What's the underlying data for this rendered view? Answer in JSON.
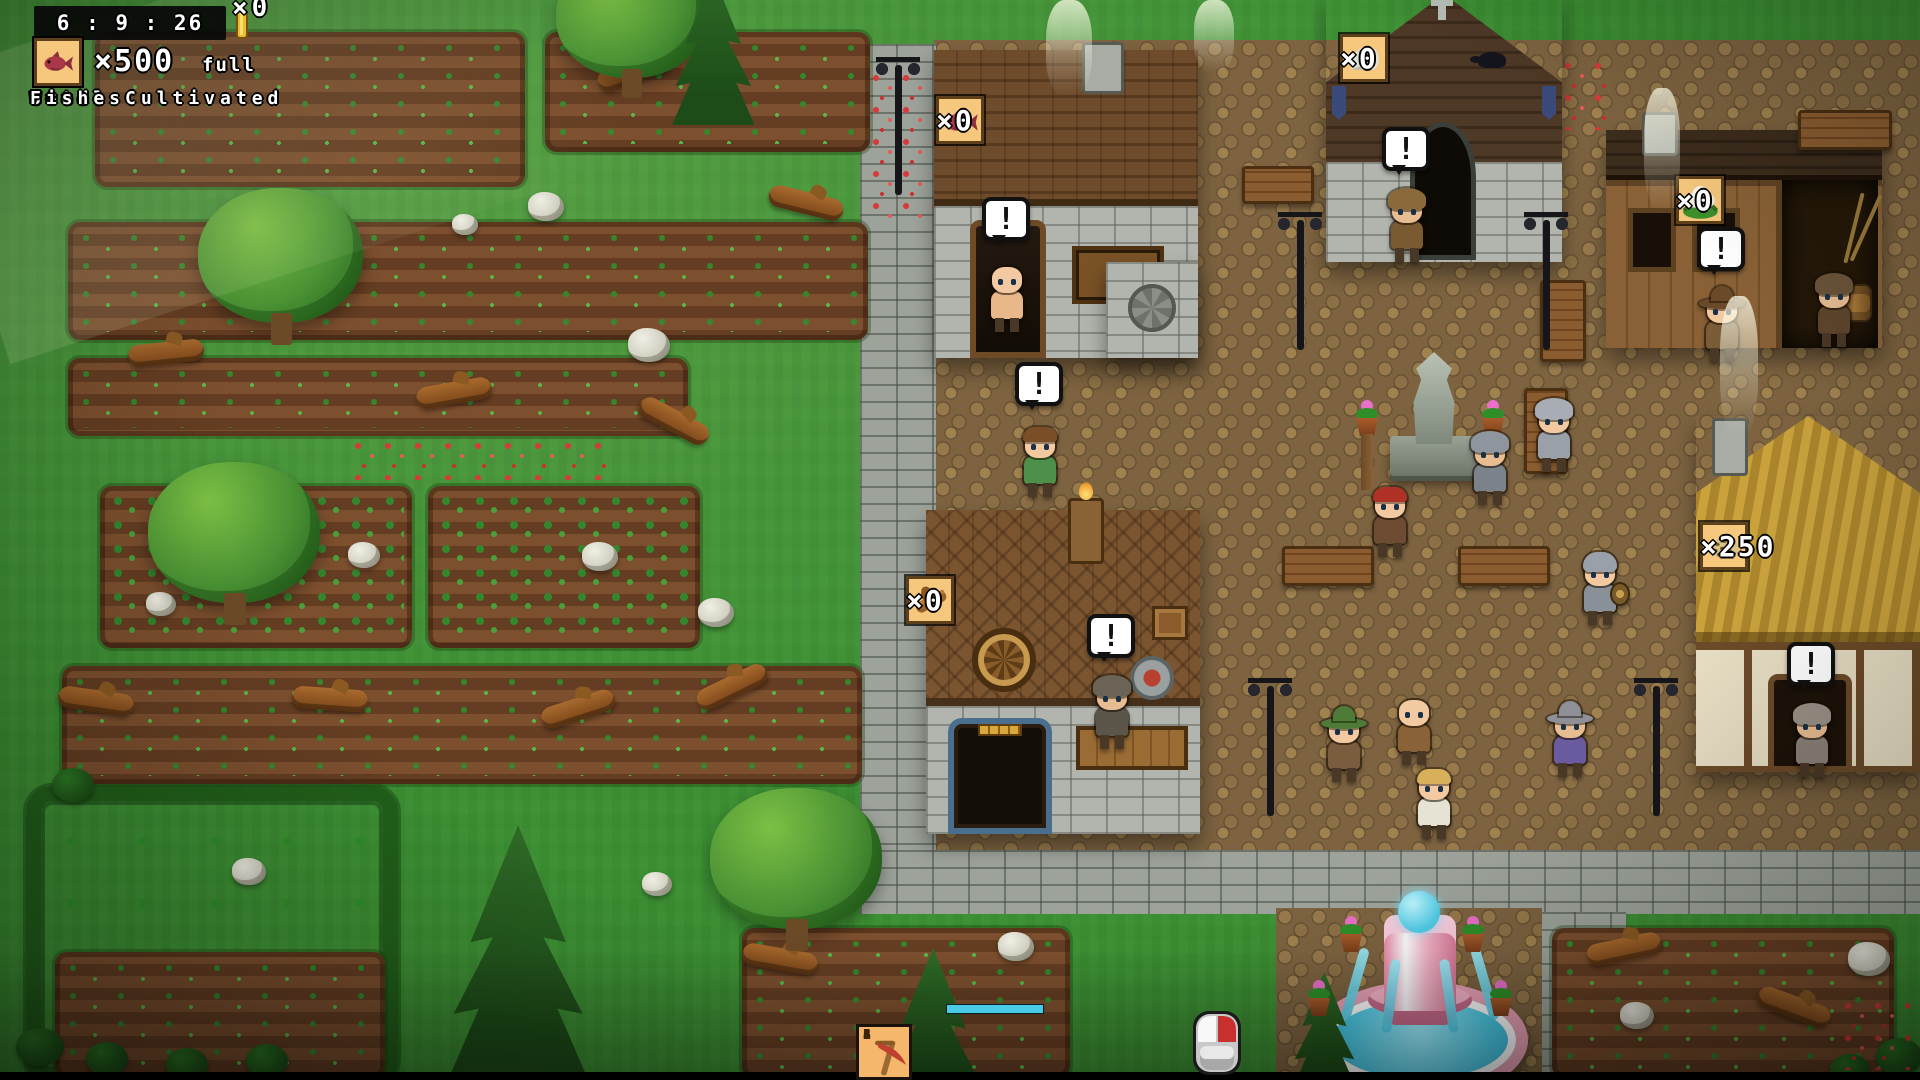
{
  "hud": {
    "clock": "6 : 9 : 26",
    "gold": {
      "icon": "gold-ingot-icon",
      "count": "×0"
    },
    "resources": [
      {
        "icon": "cauliflower-icon",
        "count": "×500",
        "suffix": "full",
        "label": "Total Cultivated"
      },
      {
        "icon": "wood-icon",
        "count": "×500",
        "suffix": "full",
        "label": "Wood"
      },
      {
        "icon": "grass-icon",
        "count": "×500",
        "suffix": "full",
        "label": "Grass"
      },
      {
        "icon": "stone-icon",
        "count": "×500",
        "suffix": "full",
        "label": "Stone"
      },
      {
        "icon": "fish-icon",
        "count": "×500",
        "suffix": "full",
        "label": "Fishes"
      }
    ]
  },
  "village_labels": [
    {
      "icon": "fish-icon",
      "count": "×0",
      "x": 936,
      "y": 96
    },
    {
      "icon": "stone-icon",
      "count": "×0",
      "x": 1340,
      "y": 34
    },
    {
      "icon": "cauliflower-icon",
      "count": "×0",
      "x": 1676,
      "y": 176
    },
    {
      "icon": "wood-icon",
      "count": "×0",
      "x": 906,
      "y": 576
    },
    {
      "icon": "seeds-icon",
      "count": "×250",
      "x": 1700,
      "y": 522
    }
  ],
  "toolbar": {
    "slots": [
      {
        "number": "1",
        "icon": "villager-icon"
      },
      {
        "number": "2",
        "icon": "pickaxe-icon"
      },
      {
        "number": "3",
        "icon": "bucket-icon"
      },
      {
        "number": "4",
        "icon": "shovel-icon"
      },
      {
        "number": "5",
        "icon": "axe-icon"
      },
      {
        "number": "6",
        "icon": "scythe-icon"
      }
    ],
    "cursor_icon": "mouse-icon",
    "progress_value": 100
  },
  "speech": {
    "exclamation": "!"
  },
  "colors": {
    "hud_box": "#f6c87e",
    "bubble": "#ffffff",
    "water": "#4ecde8",
    "progress": "#49cbe8",
    "thatch": "#c9a23c"
  },
  "scene": {
    "plots": [
      {
        "x": 95,
        "y": 32,
        "w": 430,
        "h": 155
      },
      {
        "x": 545,
        "y": 32,
        "w": 325,
        "h": 120
      },
      {
        "x": 68,
        "y": 222,
        "w": 800,
        "h": 118
      },
      {
        "x": 68,
        "y": 358,
        "w": 620,
        "h": 78
      },
      {
        "x": 100,
        "y": 486,
        "w": 312,
        "h": 162,
        "beans": true
      },
      {
        "x": 428,
        "y": 486,
        "w": 272,
        "h": 162,
        "beans": true
      },
      {
        "x": 62,
        "y": 666,
        "w": 800,
        "h": 118
      },
      {
        "x": 742,
        "y": 928,
        "w": 328,
        "h": 150
      },
      {
        "x": 1552,
        "y": 928,
        "w": 342,
        "h": 150
      },
      {
        "x": 55,
        "y": 952,
        "w": 330,
        "h": 126
      }
    ],
    "trees": [
      {
        "t": "round",
        "x": 198,
        "y": 188,
        "s": 165
      },
      {
        "t": "round",
        "x": 148,
        "y": 462,
        "s": 172
      },
      {
        "t": "round",
        "x": 710,
        "y": 788,
        "s": 172
      },
      {
        "t": "round",
        "x": 556,
        "y": -45,
        "s": 150
      },
      {
        "t": "pine",
        "x": 448,
        "y": 825,
        "s": 255
      },
      {
        "t": "pine",
        "x": 672,
        "y": -25,
        "s": 150
      },
      {
        "t": "pine",
        "x": 885,
        "y": 948,
        "s": 175
      },
      {
        "t": "pine",
        "x": 1292,
        "y": 972,
        "s": 118
      }
    ],
    "logs": [
      {
        "x": 596,
        "y": 60,
        "r": -20
      },
      {
        "x": 768,
        "y": 192,
        "r": 14
      },
      {
        "x": 416,
        "y": 382,
        "r": -10
      },
      {
        "x": 636,
        "y": 410,
        "r": 28
      },
      {
        "x": 128,
        "y": 342,
        "r": -6
      },
      {
        "x": 58,
        "y": 690,
        "r": 8
      },
      {
        "x": 292,
        "y": 688,
        "r": 4
      },
      {
        "x": 540,
        "y": 698,
        "r": -18
      },
      {
        "x": 694,
        "y": 676,
        "r": -26
      },
      {
        "x": 742,
        "y": 948,
        "r": 10
      },
      {
        "x": 1586,
        "y": 938,
        "r": -12
      },
      {
        "x": 1756,
        "y": 996,
        "r": 20
      }
    ],
    "stones": [
      {
        "x": 528,
        "y": 192,
        "s": 36
      },
      {
        "x": 452,
        "y": 214,
        "s": 26
      },
      {
        "x": 628,
        "y": 328,
        "s": 42
      },
      {
        "x": 146,
        "y": 592,
        "s": 30
      },
      {
        "x": 348,
        "y": 542,
        "s": 32
      },
      {
        "x": 582,
        "y": 542,
        "s": 36
      },
      {
        "x": 698,
        "y": 598,
        "s": 36
      },
      {
        "x": 232,
        "y": 858,
        "s": 34
      },
      {
        "x": 642,
        "y": 872,
        "s": 30
      },
      {
        "x": 998,
        "y": 932,
        "s": 36
      },
      {
        "x": 1620,
        "y": 1002,
        "s": 34
      },
      {
        "x": 1848,
        "y": 942,
        "s": 42
      }
    ],
    "bushes": [
      {
        "x": 52,
        "y": 768,
        "s": 42
      },
      {
        "x": 16,
        "y": 1028,
        "s": 48
      },
      {
        "x": 86,
        "y": 1042,
        "s": 42
      },
      {
        "x": 166,
        "y": 1048,
        "s": 42
      },
      {
        "x": 246,
        "y": 1044,
        "s": 42
      },
      {
        "x": 1876,
        "y": 1038,
        "s": 46
      },
      {
        "x": 1830,
        "y": 1054,
        "s": 40
      }
    ],
    "flowers": [
      {
        "x": 868,
        "y": 72,
        "w": 66,
        "h": 150
      },
      {
        "x": 1560,
        "y": 60,
        "w": 50,
        "h": 70
      },
      {
        "x": 1840,
        "y": 1000,
        "w": 70,
        "h": 70
      },
      {
        "x": 350,
        "y": 440,
        "w": 260,
        "h": 40
      }
    ],
    "lamps": [
      {
        "x": 868,
        "y": 55
      },
      {
        "x": 1270,
        "y": 210
      },
      {
        "x": 1516,
        "y": 210
      },
      {
        "x": 1240,
        "y": 676
      },
      {
        "x": 1626,
        "y": 676
      }
    ],
    "benches": [
      {
        "x": 1282,
        "y": 546,
        "w": 92,
        "h": 40
      },
      {
        "x": 1458,
        "y": 546,
        "w": 92,
        "h": 40
      },
      {
        "x": 1524,
        "y": 388,
        "w": 44,
        "h": 86
      },
      {
        "x": 1540,
        "y": 280,
        "w": 46,
        "h": 82
      },
      {
        "x": 1798,
        "y": 110,
        "w": 94,
        "h": 40
      },
      {
        "x": 1242,
        "y": 166,
        "w": 72,
        "h": 38
      }
    ],
    "lights": [
      {
        "x": 1046,
        "y": 0,
        "w": 46,
        "h": 96
      },
      {
        "x": 1194,
        "y": 0,
        "w": 40,
        "h": 72
      },
      {
        "x": 1644,
        "y": 88,
        "w": 36,
        "h": 122
      },
      {
        "x": 1720,
        "y": 296,
        "w": 38,
        "h": 140
      }
    ],
    "pots": [
      {
        "x": 1336,
        "y": 916
      },
      {
        "x": 1458,
        "y": 916
      },
      {
        "x": 1304,
        "y": 980
      },
      {
        "x": 1486,
        "y": 980
      },
      {
        "x": 1352,
        "y": 400,
        "tall": true
      },
      {
        "x": 1478,
        "y": 400,
        "tall": true
      }
    ],
    "characters": [
      {
        "name": "archer-villager",
        "x": 985,
        "y": 255,
        "skin": "#f2c9a0",
        "top": "bald",
        "topColor": "#f2c9a0",
        "outfit": "#e8b88a",
        "bubble": true
      },
      {
        "name": "farm-boy",
        "x": 1018,
        "y": 420,
        "skin": "#f2c9a0",
        "top": "hair",
        "topColor": "#7a4f28",
        "outfit": "#4e8f4a",
        "bubble": true
      },
      {
        "name": "church-monk",
        "x": 1385,
        "y": 185,
        "skin": "#e8bd92",
        "top": "hood",
        "topColor": "#8a6a3a",
        "outfit": "#7a5a30",
        "bubble": true
      },
      {
        "name": "hunter",
        "x": 1700,
        "y": 285,
        "skin": "#f2c9a0",
        "top": "hat",
        "topColor": "#6b4a2a",
        "outfit": "#7a5c38",
        "bubble": true
      },
      {
        "name": "fisherman",
        "x": 1812,
        "y": 270,
        "skin": "#e8bd92",
        "top": "hood",
        "topColor": "#6b543a",
        "outfit": "#5e462c",
        "bubble": false
      },
      {
        "name": "player-red-hair",
        "x": 1368,
        "y": 480,
        "skin": "#f2c9a0",
        "top": "hair",
        "topColor": "#b03226",
        "outfit": "#6e4c34",
        "bubble": false
      },
      {
        "name": "chainmail-knight",
        "x": 1532,
        "y": 395,
        "skin": "#f2c9a0",
        "top": "hood",
        "topColor": "#a8adb5",
        "outfit": "#9aa0a8",
        "bubble": false
      },
      {
        "name": "grey-hood-villager",
        "x": 1468,
        "y": 428,
        "skin": "#e8bd92",
        "top": "hood",
        "topColor": "#8f959c",
        "outfit": "#7c828a",
        "bubble": false
      },
      {
        "name": "shield-knight",
        "x": 1578,
        "y": 548,
        "skin": "#f2c9a0",
        "top": "helmet",
        "topColor": "#9aa0a8",
        "outfit": "#8a9098",
        "shield": true,
        "bubble": false
      },
      {
        "name": "blacksmith",
        "x": 1090,
        "y": 672,
        "skin": "#e8bd92",
        "top": "hood",
        "topColor": "#6b6355",
        "outfit": "#5c554a",
        "bubble": true
      },
      {
        "name": "green-hat-hunter",
        "x": 1322,
        "y": 705,
        "skin": "#f2c9a0",
        "top": "hat",
        "topColor": "#4e7c38",
        "outfit": "#7a5d3f",
        "bubble": false
      },
      {
        "name": "bald-monk",
        "x": 1392,
        "y": 688,
        "skin": "#f2c9a0",
        "top": "bald",
        "topColor": "#f2c9a0",
        "outfit": "#8a6238",
        "bubble": false
      },
      {
        "name": "blonde-villager",
        "x": 1412,
        "y": 762,
        "skin": "#f2c9a0",
        "top": "hair",
        "topColor": "#d8b05a",
        "outfit": "#e6e2d4",
        "bubble": false
      },
      {
        "name": "wizard",
        "x": 1548,
        "y": 700,
        "skin": "#e8bd92",
        "top": "hat",
        "topColor": "#8f8f98",
        "outfit": "#6a5a9e",
        "bubble": false
      },
      {
        "name": "barn-monk",
        "x": 1790,
        "y": 700,
        "skin": "#e8bd92",
        "top": "hood",
        "topColor": "#9a9086",
        "outfit": "#8a8076",
        "bubble": true
      }
    ]
  }
}
